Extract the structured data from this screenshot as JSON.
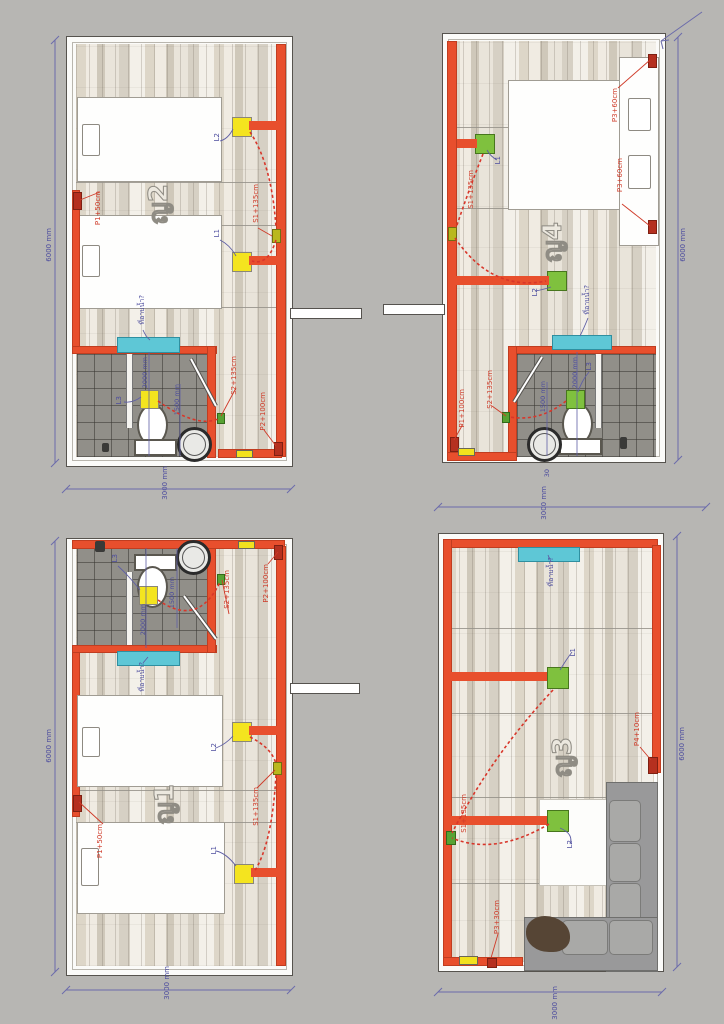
{
  "palette": {
    "wall_red": "#e84f2d",
    "switch_yellow": "#f2e21f",
    "switch_green": "#7fc13e",
    "basin_cyan": "#5ec7d6",
    "wiring_dash_red": "#d8362a",
    "dimension_blue": "#6b6bab",
    "background_gray": "#b7b6b3"
  },
  "dims": {
    "h6000": "6000 mm",
    "w3000": "3000 mm",
    "bath_depth": "2000 mm",
    "bath_width": "1500 mm",
    "small30": "30"
  },
  "rooms": {
    "room2": {
      "label": "ญ2",
      "l1": "L1",
      "l2": "L2",
      "l3": "L3",
      "s1": "S1+135cm",
      "p1": "P1+50cm",
      "s2": "S2+135cm",
      "p2": "P2+100cm",
      "basin": "ที่อาบน้ำ?"
    },
    "room4": {
      "label": "ญ4",
      "l1": "L1",
      "l2": "L2",
      "l3": "L3",
      "s1": "S1+135cm",
      "p3_top": "P3+60cm",
      "p3_bottom": "P3+60cm",
      "s2": "S2+135cm",
      "p1": "P1+100cm",
      "basin": "ที่อาบน้ำ?"
    },
    "room1": {
      "label": "ญ1",
      "l1": "L1",
      "l2": "L2",
      "l3": "L3",
      "s1": "S1+135cm",
      "p1": "P1+50cm",
      "s2": "S2+135cm",
      "p2": "P2+100cm",
      "basin": "ที่อาบน้ำ?"
    },
    "room3": {
      "label": "ญ3",
      "l1": "L1",
      "l2": "L2",
      "s1": "S1+135cm",
      "p4": "P4+10cm",
      "p3": "P3+30cm",
      "basin": "ที่อาบน้ำ?"
    }
  }
}
